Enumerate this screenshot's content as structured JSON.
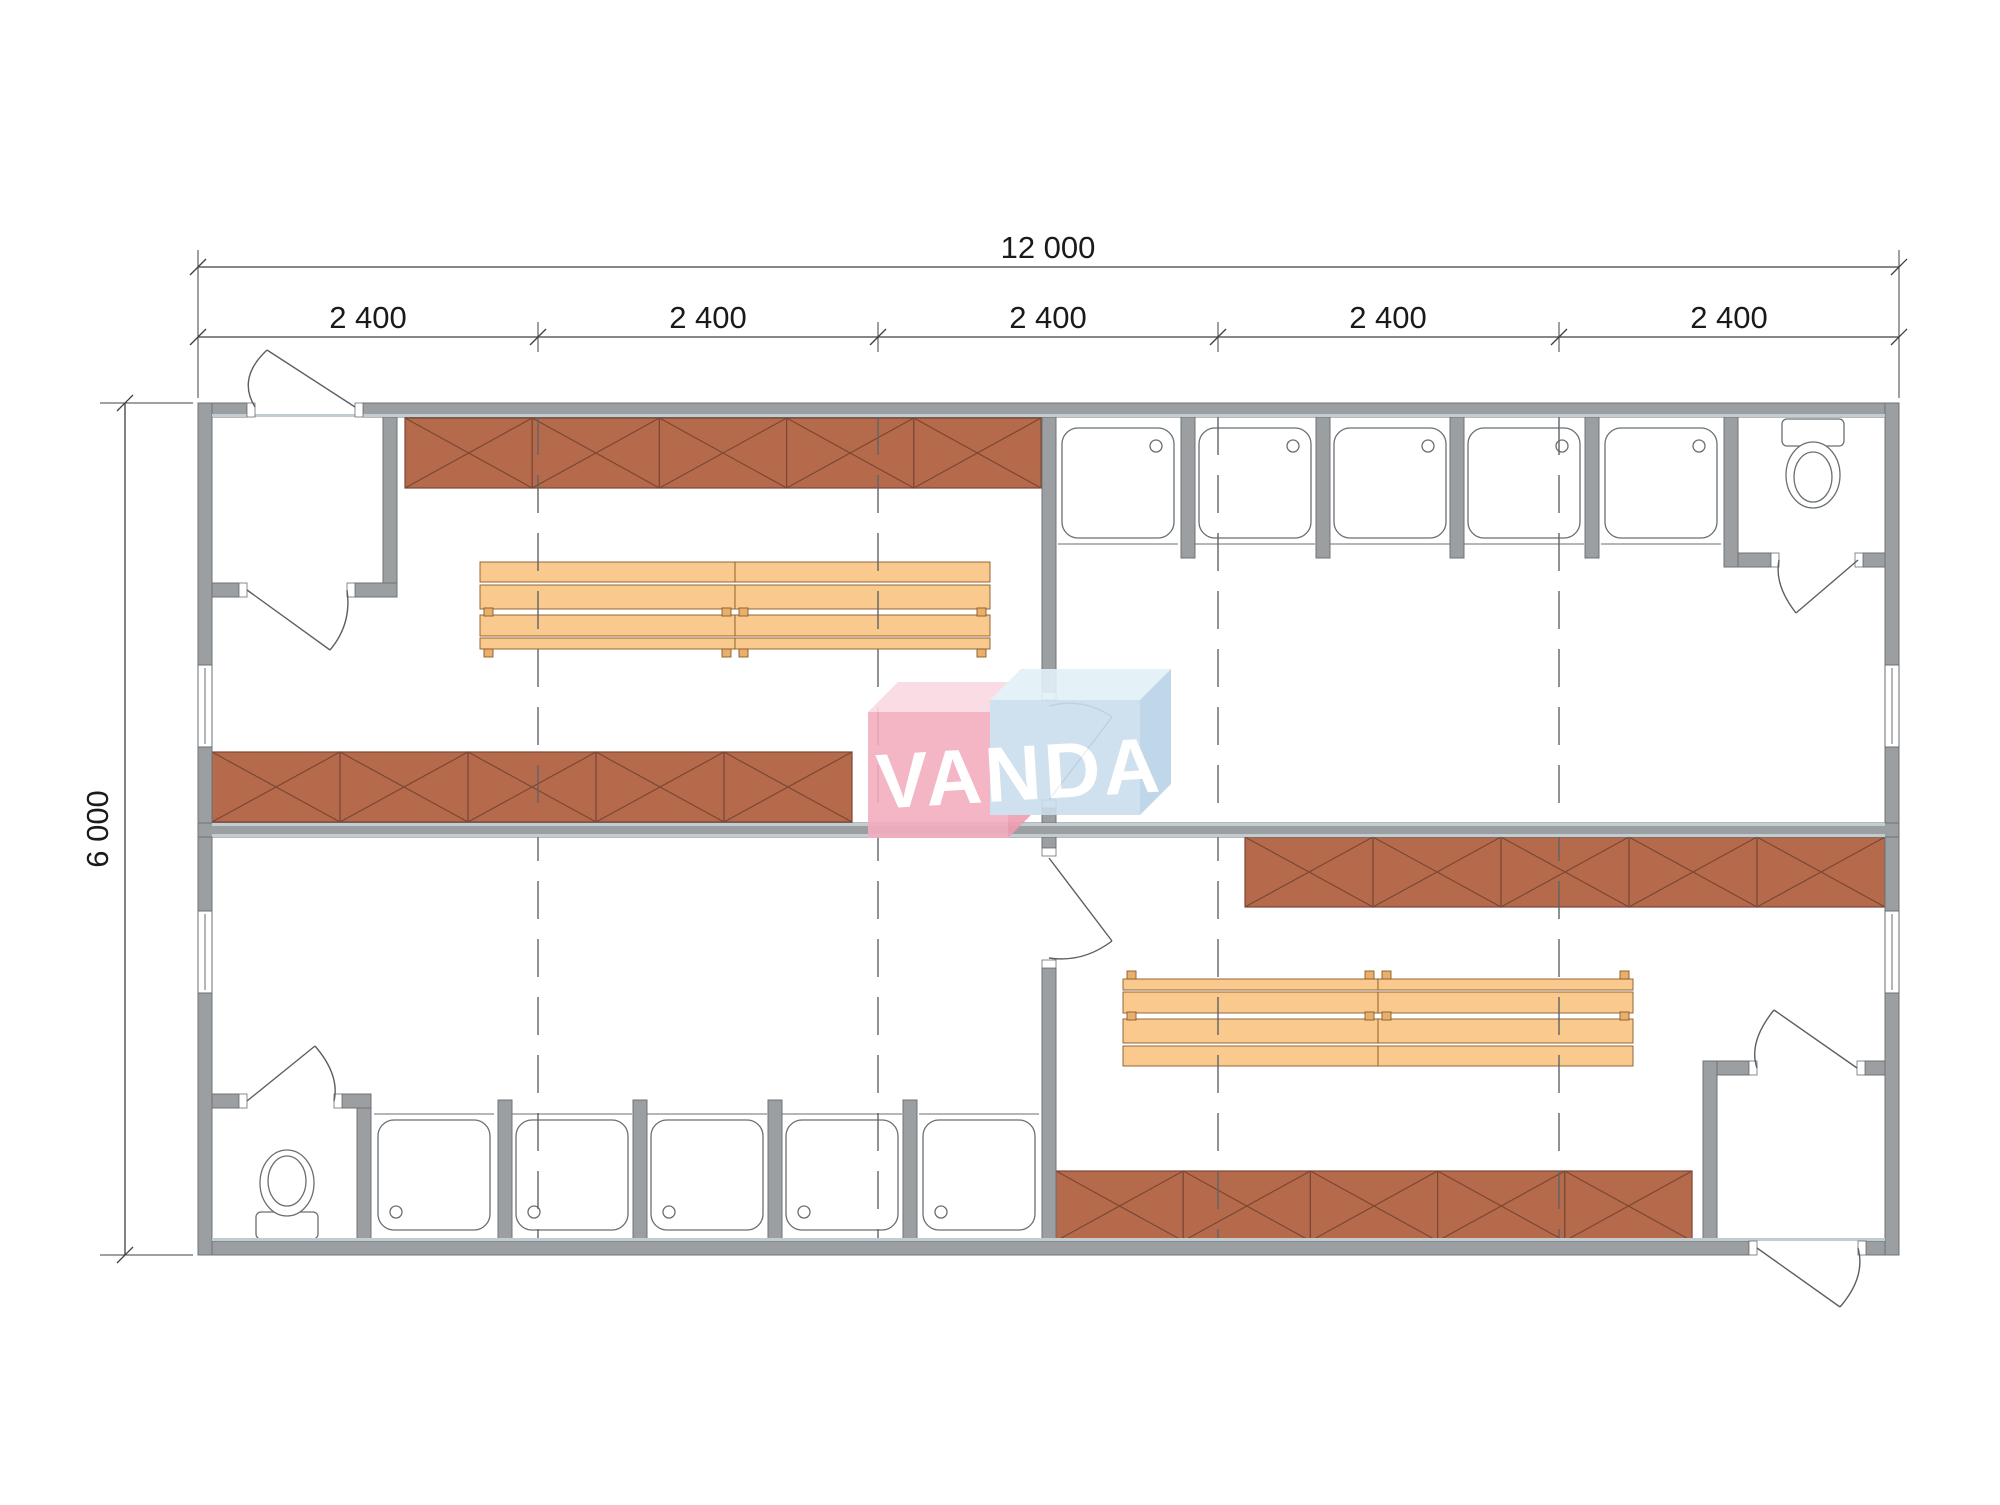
{
  "drawing": {
    "type": "modular sanitary building floor plan",
    "watermark_text": "VANDA"
  },
  "dimensions": {
    "overall_width_label": "12 000",
    "module_labels": [
      "2 400",
      "2 400",
      "2 400",
      "2 400",
      "2 400"
    ],
    "overall_height_label": "6 000"
  },
  "fixtures": {
    "shower_stalls_top_row": 5,
    "shower_stalls_bottom_row": 5,
    "toilets": 2,
    "benches": 4,
    "locker_runs": 4,
    "locker_units_per_run": 5,
    "windows": 4,
    "exterior_doors": 2,
    "interior_doors": 6
  },
  "colors": {
    "background": "#ffffff",
    "wall": "#9c9fa1",
    "wall_outline": "#6f7376",
    "wall_inner_face": "#c3ccd1",
    "locker_fill": "#b56a4c",
    "locker_line": "#7b4733",
    "bench_fill": "#f9c98e",
    "bench_line": "#8a5a28",
    "bench_foot": "#e8b06a",
    "fixture_line": "#6a6f72",
    "door_line": "#5a5f63",
    "grid_line": "#5f6466",
    "dim_line": "#3c4043",
    "dim_text": "#1a1a1a",
    "logo_pink_front": "#f3aebf",
    "logo_pink_top": "#fad9e2",
    "logo_pink_side": "#ee9db1",
    "logo_blue_front": "#cadded",
    "logo_blue_top": "#e2f1f8",
    "logo_blue_side": "#b9d3e6",
    "logo_text": "#ffffff"
  }
}
